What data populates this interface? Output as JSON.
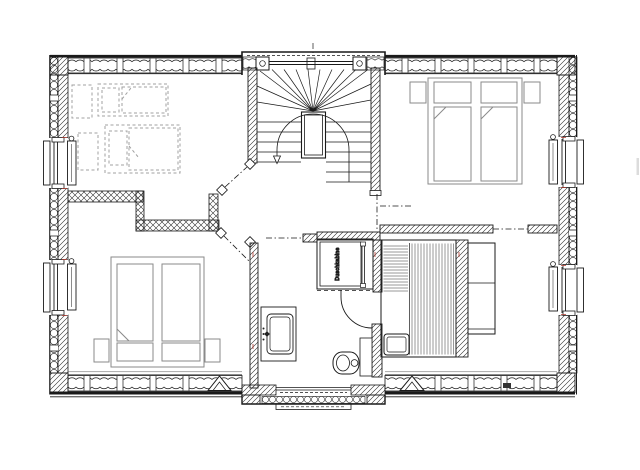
{
  "plan": {
    "labels": {
      "shower": "Duschkabine"
    },
    "colors": {
      "line": "#1a1a1a",
      "wall_hatch": "#2a2a2a",
      "furniture": "#8a8a8a",
      "planned_furniture": "#a0a0a0",
      "accent_red": "#b23a2e",
      "background": "#ffffff"
    }
  }
}
